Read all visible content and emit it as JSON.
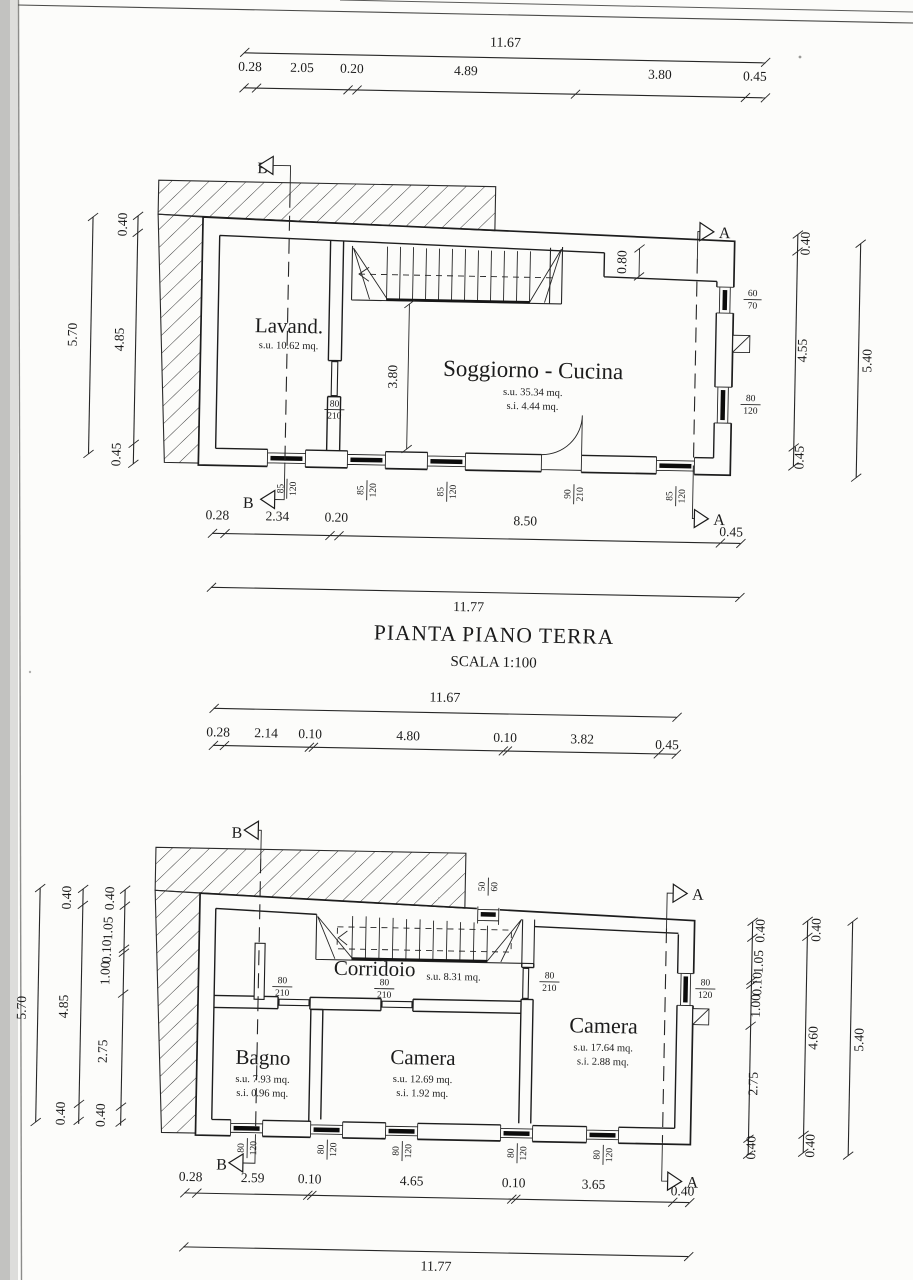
{
  "document": {
    "title": "PIANTA PIANO TERRA",
    "scale_label": "SCALA 1:100"
  },
  "markers": {
    "a": "A",
    "b": "B"
  },
  "ground_floor": {
    "dims": {
      "top_total": "11.67",
      "top_chain": [
        "0.28",
        "2.05",
        "0.20",
        "4.89",
        "3.80",
        "0.45"
      ],
      "left_total": "5.70",
      "left_chain": [
        "0.40",
        "4.85",
        "0.45"
      ],
      "right_chain": [
        "0.40",
        "4.55",
        "0.45"
      ],
      "right_total": "5.40",
      "bottom_chain": [
        "0.28",
        "2.34",
        "0.20",
        "8.50",
        "0.45"
      ],
      "bottom_total": "11.77",
      "stair_depth": "3.80",
      "recess": "0.80"
    },
    "rooms": [
      {
        "name": "Lavand.",
        "area": "s.u. 10.62 mq.",
        "area2": ""
      },
      {
        "name": "Soggiorno - Cucina",
        "area": "s.u. 35.34 mq.",
        "area2": "s.i. 4.44 mq."
      }
    ],
    "openings": {
      "interior_door": {
        "num": "80",
        "den": "210"
      },
      "bottom": [
        {
          "num": "85",
          "den": "120"
        },
        {
          "num": "85",
          "den": "120"
        },
        {
          "num": "85",
          "den": "120"
        },
        {
          "num": "90",
          "den": "210"
        },
        {
          "num": "85",
          "den": "120"
        }
      ],
      "right": [
        {
          "num": "60",
          "den": "70"
        },
        {
          "num": "80",
          "den": "120"
        }
      ]
    }
  },
  "first_floor": {
    "dims": {
      "top_total": "11.67",
      "top_chain": [
        "0.28",
        "2.14",
        "0.10",
        "4.80",
        "0.10",
        "3.82",
        "0.45"
      ],
      "left_total": "5.70",
      "left_mid_chain": [
        "0.40",
        "4.85",
        "0.40"
      ],
      "left_inner_chain": [
        "0.40",
        "1.05",
        "0.10",
        "1.00",
        "2.75",
        "0.40"
      ],
      "right_inner_chain": [
        "0.40",
        "1.05",
        "0.10",
        "1.00",
        "2.75",
        "0.40"
      ],
      "right_mid_chain": [
        "0.40",
        "4.60",
        "0.40"
      ],
      "right_total": "5.40",
      "bottom_chain": [
        "0.28",
        "2.59",
        "0.10",
        "4.65",
        "0.10",
        "3.65",
        "0.40"
      ],
      "bottom_total": "11.77"
    },
    "rooms": [
      {
        "name": "Corridoio",
        "area": "s.u. 8.31 mq.",
        "area2": ""
      },
      {
        "name": "Bagno",
        "area": "s.u. 7.93 mq.",
        "area2": "s.i. 0.96 mq."
      },
      {
        "name": "Camera",
        "area": "s.u. 12.69 mq.",
        "area2": "s.i. 1.92 mq."
      },
      {
        "name": "Camera",
        "area": "s.u. 17.64 mq.",
        "area2": "s.i. 2.88 mq."
      }
    ],
    "openings": {
      "top_window": {
        "num": "50",
        "den": "60"
      },
      "doors": [
        {
          "num": "80",
          "den": "210"
        },
        {
          "num": "80",
          "den": "210"
        },
        {
          "num": "80",
          "den": "210"
        }
      ],
      "right_window": {
        "num": "80",
        "den": "120"
      },
      "bottom": [
        {
          "num": "80",
          "den": "120"
        },
        {
          "num": "80",
          "den": "120"
        },
        {
          "num": "80",
          "den": "120"
        },
        {
          "num": "80",
          "den": "120"
        },
        {
          "num": "80",
          "den": "120"
        }
      ]
    }
  }
}
